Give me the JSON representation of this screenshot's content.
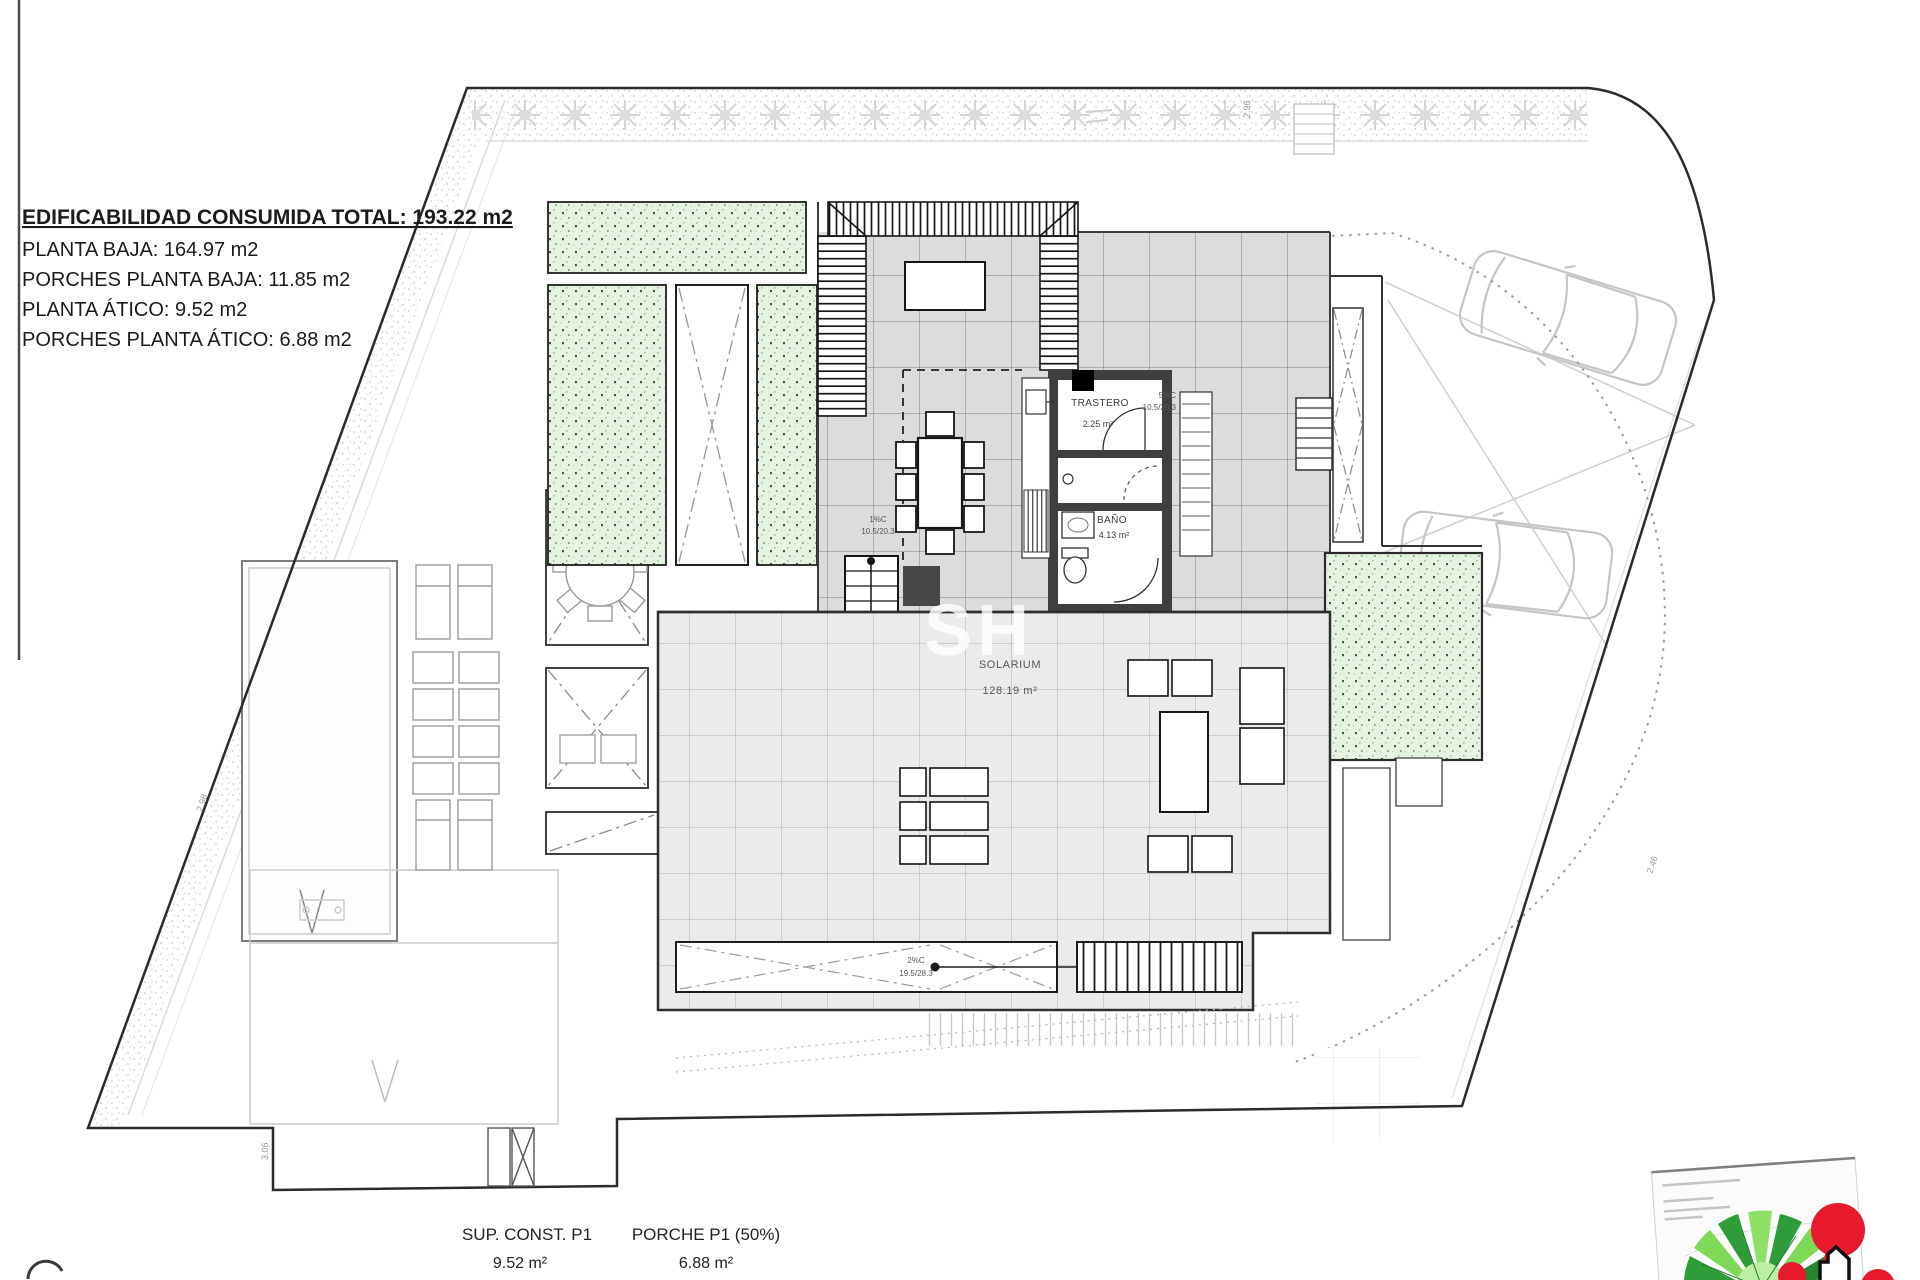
{
  "info_block": {
    "title": "EDIFICABILIDAD CONSUMIDA TOTAL: 193.22 m2",
    "lines": [
      "PLANTA BAJA: 164.97 m2",
      "PORCHES PLANTA BAJA: 11.85 m2",
      "PLANTA ÁTICO: 9.52 m2",
      "PORCHES PLANTA ÁTICO: 6.88 m2"
    ]
  },
  "rooms": {
    "trastero": {
      "name": "TRASTERO",
      "area": "2.25 m²"
    },
    "bano": {
      "name": "BAÑO",
      "area": "4.13 m²"
    },
    "solarium": {
      "name": "SOLARIUM",
      "area": "128.19 m²"
    }
  },
  "annotations": {
    "stair_note_top": {
      "l1": "1%C",
      "l2": "10.5/20.3"
    },
    "stair_note_bottom": {
      "l1": "2%C",
      "l2": "19.5/28.3"
    },
    "stair_note_right": {
      "l1": "5%C",
      "l2": "10.5/20.3"
    },
    "dims": {
      "top_right": "2.96",
      "left": "2.98",
      "bottom": "3.06",
      "right": "2.46"
    }
  },
  "footer": {
    "col1": {
      "label": "SUP. CONST. P1",
      "value": "9.52 m²"
    },
    "col2": {
      "label": "PORCHE P1 (50%)",
      "value": "6.88 m²"
    }
  },
  "watermark": {
    "text": "SH"
  },
  "colors": {
    "terrace_tile": "#dcdcdc",
    "solarium_tile": "#ebebeb",
    "garden_green": "#e7f3e2",
    "wall_dark": "#3f3f3f",
    "logo_red": "#e8192c",
    "logo_green": "#3fae49"
  }
}
